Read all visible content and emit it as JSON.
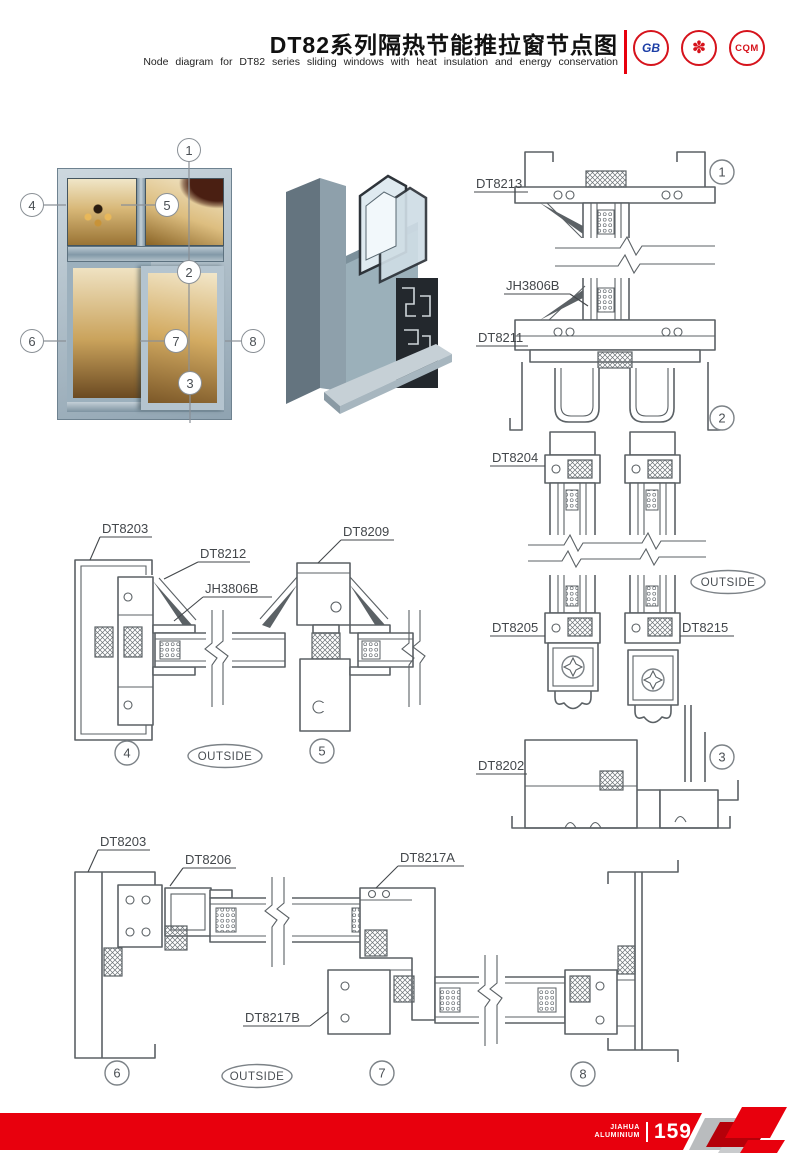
{
  "colors": {
    "accent_red": "#e8000d",
    "line_gray": "#5b6165",
    "circle_stroke": "#7c8287"
  },
  "header": {
    "title": "DT82系列隔热节能推拉窗节点图",
    "subtitle": "Node diagram for DT82 series sliding windows with heat insulation and energy conservation",
    "logos": [
      {
        "name": "gb-certification-logo",
        "label": "GB"
      },
      {
        "name": "quality-seal-logo",
        "label": "✽"
      },
      {
        "name": "cqm-certification-logo",
        "label": "CQM"
      }
    ]
  },
  "photo": {
    "callouts": {
      "c1": "1",
      "c2": "2",
      "c3": "3",
      "c4": "4",
      "c5": "5",
      "c6": "6",
      "c7": "7",
      "c8": "8"
    }
  },
  "diag_right": {
    "dt8213": "DT8213",
    "jh3806b": "JH3806B",
    "dt8211": "DT8211",
    "dt8204": "DT8204",
    "dt8205": "DT8205",
    "dt8215": "DT8215",
    "dt8202": "DT8202",
    "c1": "1",
    "c2": "2",
    "c3": "3",
    "outside": "OUTSIDE"
  },
  "diag_mid": {
    "dt8203": "DT8203",
    "dt8212": "DT8212",
    "jh3806b": "JH3806B",
    "dt8209": "DT8209",
    "c4": "4",
    "c5": "5",
    "outside": "OUTSIDE"
  },
  "diag_bottom": {
    "dt8203": "DT8203",
    "dt8206": "DT8206",
    "dt8217a": "DT8217A",
    "dt8217b": "DT8217B",
    "c6": "6",
    "c7": "7",
    "c8": "8",
    "outside": "OUTSIDE"
  },
  "footer": {
    "brand_top": "JIAHUA",
    "brand_bottom": "ALUMINIUM",
    "page_number": "159"
  }
}
